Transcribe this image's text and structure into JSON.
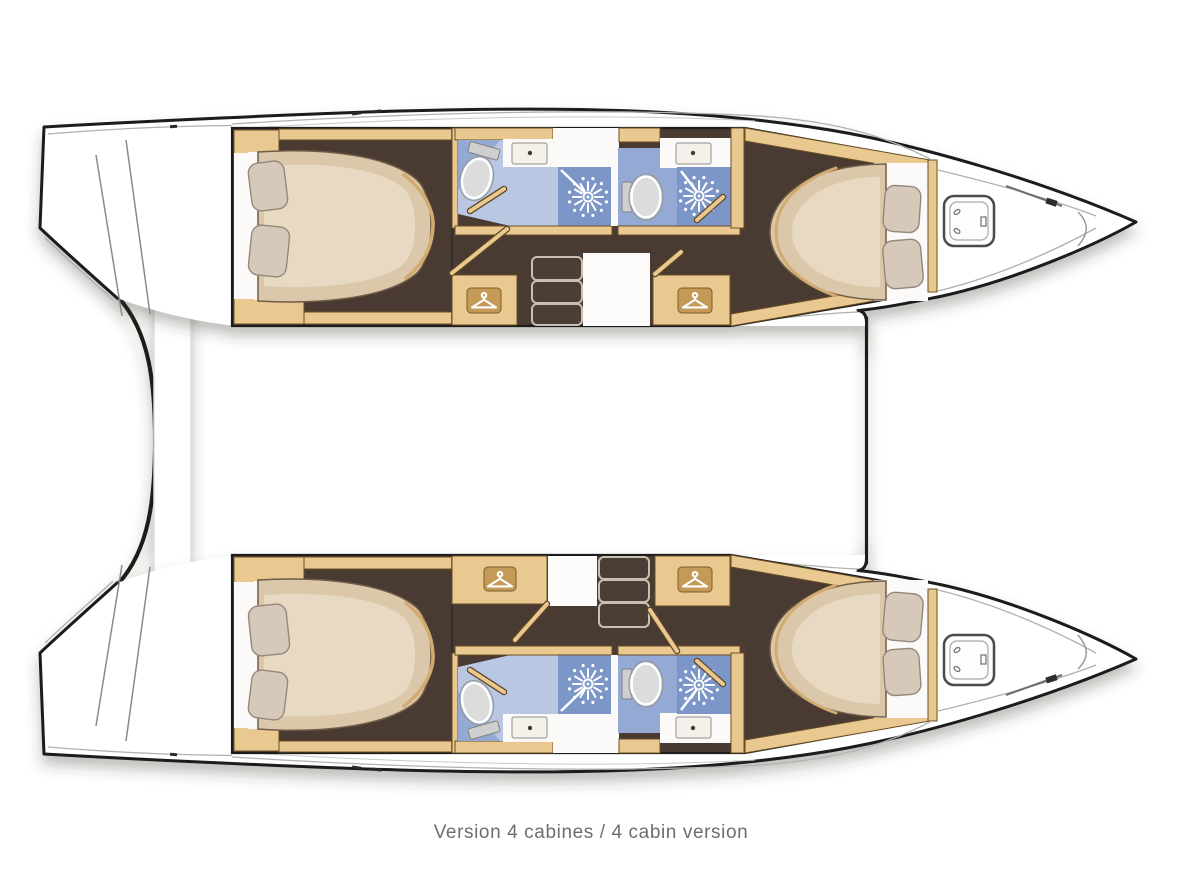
{
  "diagram": {
    "caption": "Version 4 cabines / 4 cabin version"
  },
  "colors": {
    "page": "#ffffff",
    "outline": "#1a1a1a",
    "wood": "#e9c98f",
    "woodDark": "#c49a56",
    "floor": "#4a3a31",
    "mattress": "#dbc8ab",
    "mattressLight": "#e8dac2",
    "pillow": "#d7c9ba",
    "bathLight": "#b9c7e3",
    "bathMid": "#94a9d4",
    "bathShower": "#7b96c8",
    "caption": "#6e6e6e"
  },
  "icons": {
    "wardrobe": "hanger-icon",
    "shower": "shower-head-icon",
    "toilet": "toilet-icon",
    "sink": "sink-icon",
    "foredeck_hatch": "deck-hatch-icon",
    "stairs": "companionway-steps"
  }
}
